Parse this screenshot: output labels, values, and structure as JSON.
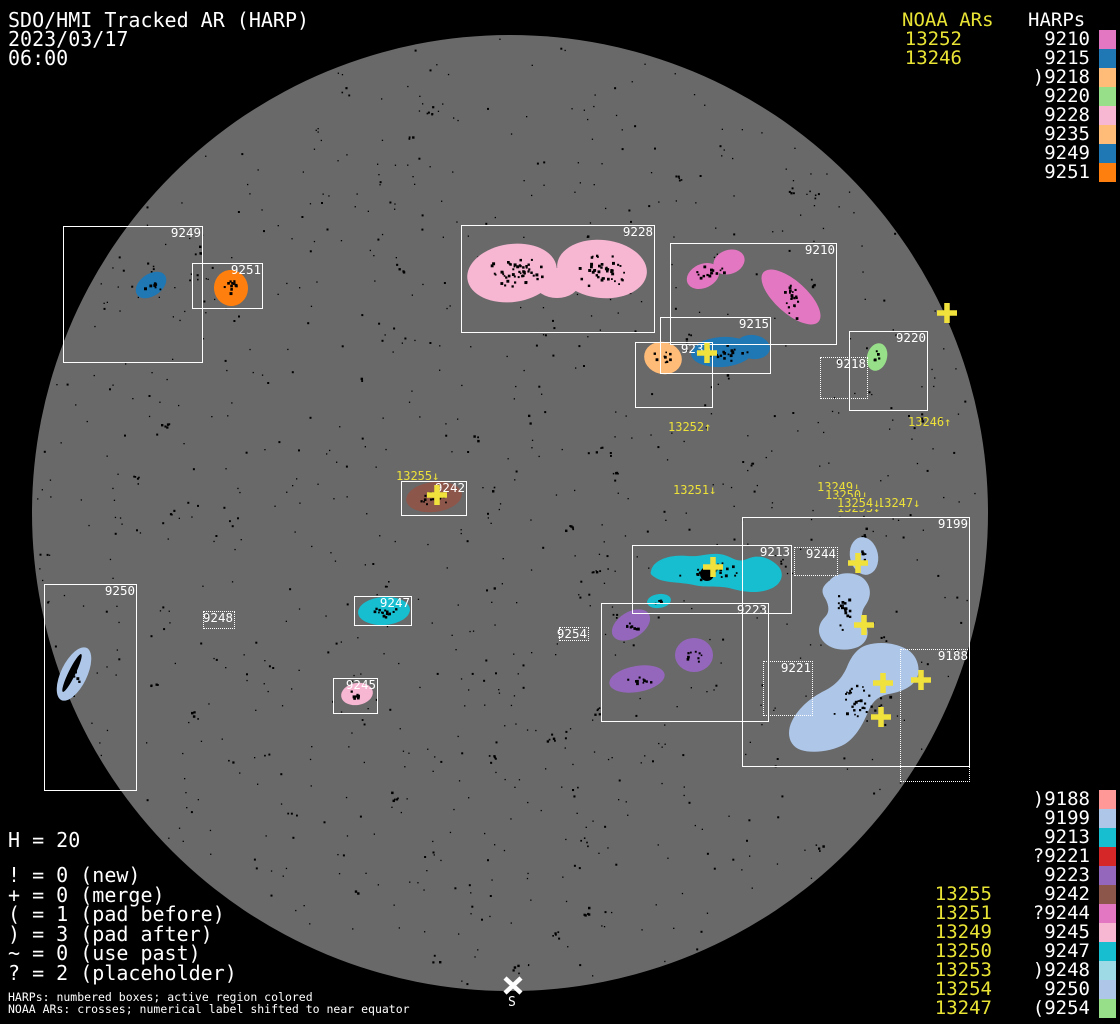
{
  "header": {
    "title": "SDO/HMI Tracked AR (HARP)",
    "date": "2023/03/17",
    "time": "06:00"
  },
  "colors": {
    "background": "#000000",
    "disk": "#696969",
    "box_border": "#ffffff",
    "noaa_text": "#e8e334",
    "cross": "#f0e13c",
    "speckle": "#000000"
  },
  "legend_top": {
    "noaa_header": "NOAA ARs",
    "harp_header": "HARPs",
    "rows": [
      {
        "noaa": "13252",
        "harp": "9210",
        "color": "#e377c2"
      },
      {
        "noaa": "13246",
        "harp": "9215",
        "color": "#1f77b4"
      },
      {
        "noaa": "",
        "harp": ")9218",
        "color": "#ffbb78"
      },
      {
        "noaa": "",
        "harp": "9220",
        "color": "#98df8a"
      },
      {
        "noaa": "",
        "harp": "9228",
        "color": "#f7b6d2"
      },
      {
        "noaa": "",
        "harp": "9235",
        "color": "#ffbb78"
      },
      {
        "noaa": "",
        "harp": "9249",
        "color": "#1f77b4"
      },
      {
        "noaa": "",
        "harp": "9251",
        "color": "#ff7f0e"
      }
    ]
  },
  "legend_bottom": {
    "rows": [
      {
        "noaa": "",
        "harp": ")9188",
        "color": "#ff9896"
      },
      {
        "noaa": "",
        "harp": "9199",
        "color": "#aec7e8"
      },
      {
        "noaa": "",
        "harp": "9213",
        "color": "#17becf"
      },
      {
        "noaa": "",
        "harp": "?9221",
        "color": "#d62728"
      },
      {
        "noaa": "",
        "harp": "9223",
        "color": "#9467bd"
      },
      {
        "noaa": "13255",
        "harp": "9242",
        "color": "#8c564b"
      },
      {
        "noaa": "13251",
        "harp": "?9244",
        "color": "#e377c2"
      },
      {
        "noaa": "13249",
        "harp": "9245",
        "color": "#f7b6d2"
      },
      {
        "noaa": "13250",
        "harp": "9247",
        "color": "#17becf"
      },
      {
        "noaa": "13253",
        "harp": ")9248",
        "color": "#9edae5"
      },
      {
        "noaa": "13254",
        "harp": "9250",
        "color": "#aec7e8"
      },
      {
        "noaa": "13247",
        "harp": "(9254",
        "color": "#98df8a"
      }
    ]
  },
  "stats": {
    "h_line": "H = 20",
    "lines": [
      "! = 0 (new)",
      "+ = 0 (merge)",
      "( = 1 (pad before)",
      ") = 3 (pad after)",
      "~ = 0 (use past)",
      "? = 2 (placeholder)"
    ]
  },
  "footnotes": [
    "HARPs: numbered boxes; active region colored",
    "NOAA ARs: crosses; numerical label shifted to near equator"
  ],
  "south_marker": {
    "x": 513,
    "y": 985,
    "label": "S"
  },
  "disk": {
    "cx": 510,
    "cy": 513,
    "r": 478
  },
  "harp_boxes": [
    {
      "label": "9249",
      "x": 63,
      "y": 226,
      "w": 140,
      "h": 137,
      "dotted": false
    },
    {
      "label": "9251",
      "x": 192,
      "y": 263,
      "w": 71,
      "h": 46,
      "dotted": false
    },
    {
      "label": "9228",
      "x": 461,
      "y": 225,
      "w": 194,
      "h": 108,
      "dotted": false
    },
    {
      "label": "9210",
      "x": 670,
      "y": 243,
      "w": 167,
      "h": 102,
      "dotted": false
    },
    {
      "label": "9215",
      "x": 660,
      "y": 317,
      "w": 111,
      "h": 57,
      "dotted": false
    },
    {
      "label": "9235",
      "x": 635,
      "y": 342,
      "w": 78,
      "h": 66,
      "dotted": false
    },
    {
      "label": "9220",
      "x": 849,
      "y": 331,
      "w": 79,
      "h": 80,
      "dotted": false
    },
    {
      "label": "9218",
      "x": 820,
      "y": 357,
      "w": 48,
      "h": 42,
      "dotted": true
    },
    {
      "label": "9242",
      "x": 401,
      "y": 481,
      "w": 66,
      "h": 35,
      "dotted": false
    },
    {
      "label": "9250",
      "x": 44,
      "y": 584,
      "w": 93,
      "h": 207,
      "dotted": false
    },
    {
      "label": "9247",
      "x": 354,
      "y": 596,
      "w": 58,
      "h": 30,
      "dotted": false
    },
    {
      "label": "9245",
      "x": 333,
      "y": 678,
      "w": 45,
      "h": 36,
      "dotted": false
    },
    {
      "label": "9248",
      "x": 203,
      "y": 611,
      "w": 32,
      "h": 18,
      "dotted": true
    },
    {
      "label": "9254",
      "x": 559,
      "y": 627,
      "w": 30,
      "h": 14,
      "dotted": true
    },
    {
      "label": "9213",
      "x": 632,
      "y": 545,
      "w": 160,
      "h": 69,
      "dotted": false
    },
    {
      "label": "9223",
      "x": 601,
      "y": 603,
      "w": 168,
      "h": 119,
      "dotted": false
    },
    {
      "label": "9199",
      "x": 742,
      "y": 517,
      "w": 228,
      "h": 250,
      "dotted": false
    },
    {
      "label": "9244",
      "x": 794,
      "y": 547,
      "w": 44,
      "h": 29,
      "dotted": true
    },
    {
      "label": "9221",
      "x": 763,
      "y": 661,
      "w": 50,
      "h": 55,
      "dotted": true
    },
    {
      "label": "9188",
      "x": 900,
      "y": 649,
      "w": 70,
      "h": 133,
      "dotted": true
    }
  ],
  "noaa_disk_labels": [
    {
      "text": "13252↑",
      "x": 668,
      "y": 421,
      "bg": false
    },
    {
      "text": "13246↑",
      "x": 908,
      "y": 416,
      "bg": false
    },
    {
      "text": "13255↓",
      "x": 396,
      "y": 470,
      "bg": false
    },
    {
      "text": "13251↓",
      "x": 673,
      "y": 484,
      "bg": false
    },
    {
      "text": "13249↓",
      "x": 817,
      "y": 481,
      "bg": false
    },
    {
      "text": "13250↓",
      "x": 825,
      "y": 489,
      "bg": true
    },
    {
      "text": "13253↓",
      "x": 837,
      "y": 502,
      "bg": true
    },
    {
      "text": "13247↓",
      "x": 877,
      "y": 497,
      "bg": true
    },
    {
      "text": "13254↓",
      "x": 837,
      "y": 497,
      "bg": true
    }
  ],
  "crosses": [
    [
      707,
      353
    ],
    [
      947,
      313
    ],
    [
      437,
      495
    ],
    [
      713,
      567
    ],
    [
      858,
      563
    ],
    [
      864,
      625
    ],
    [
      883,
      683
    ],
    [
      921,
      680
    ],
    [
      881,
      717
    ]
  ],
  "active_regions": [
    {
      "harp": "9249",
      "color": "#1f77b4",
      "shapes": [
        {
          "t": "e",
          "cx": 151,
          "cy": 285,
          "rx": 17,
          "ry": 11,
          "rot": -35
        }
      ],
      "speckles": [
        {
          "cx": 151,
          "cy": 285,
          "n": 8,
          "sx": 11,
          "sy": 6
        }
      ]
    },
    {
      "harp": "9251",
      "color": "#ff7f0e",
      "shapes": [
        {
          "t": "e",
          "cx": 231,
          "cy": 288,
          "rx": 17,
          "ry": 18,
          "rot": -8
        }
      ],
      "speckles": [
        {
          "cx": 231,
          "cy": 287,
          "n": 14,
          "sx": 11,
          "sy": 12
        }
      ]
    },
    {
      "harp": "9228",
      "color": "#f7b6d2",
      "shapes": [
        {
          "t": "e",
          "cx": 512,
          "cy": 273,
          "rx": 45,
          "ry": 29,
          "rot": -8
        },
        {
          "t": "e",
          "cx": 602,
          "cy": 269,
          "rx": 45,
          "ry": 29,
          "rot": 6
        },
        {
          "t": "e",
          "cx": 557,
          "cy": 283,
          "rx": 22,
          "ry": 15,
          "rot": 0
        }
      ],
      "speckles": [
        {
          "cx": 514,
          "cy": 272,
          "n": 50,
          "sx": 36,
          "sy": 20
        },
        {
          "cx": 600,
          "cy": 268,
          "n": 42,
          "sx": 30,
          "sy": 22
        }
      ]
    },
    {
      "harp": "9210",
      "color": "#e377c2",
      "shapes": [
        {
          "t": "e",
          "cx": 703,
          "cy": 276,
          "rx": 17,
          "ry": 12,
          "rot": -25
        },
        {
          "t": "e",
          "cx": 729,
          "cy": 262,
          "rx": 16,
          "ry": 12,
          "rot": -20
        },
        {
          "t": "e",
          "cx": 791,
          "cy": 297,
          "rx": 37,
          "ry": 16,
          "rot": 42
        }
      ],
      "speckles": [
        {
          "cx": 710,
          "cy": 271,
          "n": 16,
          "sx": 18,
          "sy": 10
        },
        {
          "cx": 791,
          "cy": 297,
          "n": 20,
          "sx": 12,
          "sy": 24
        }
      ]
    },
    {
      "harp": "9215",
      "color": "#1f77b4",
      "shapes": [
        {
          "t": "e",
          "cx": 722,
          "cy": 352,
          "rx": 31,
          "ry": 15,
          "rot": -4
        },
        {
          "t": "e",
          "cx": 753,
          "cy": 347,
          "rx": 17,
          "ry": 12,
          "rot": 8
        }
      ],
      "speckles": [
        {
          "cx": 727,
          "cy": 352,
          "n": 20,
          "sx": 28,
          "sy": 10
        }
      ]
    },
    {
      "harp": "9235",
      "color": "#ffbb78",
      "shapes": [
        {
          "t": "e",
          "cx": 663,
          "cy": 358,
          "rx": 19,
          "ry": 16,
          "rot": 14
        }
      ],
      "speckles": [
        {
          "cx": 661,
          "cy": 357,
          "n": 9,
          "sx": 12,
          "sy": 10
        }
      ]
    },
    {
      "harp": "9220",
      "color": "#98df8a",
      "shapes": [
        {
          "t": "e",
          "cx": 877,
          "cy": 357,
          "rx": 10,
          "ry": 14,
          "rot": 16
        }
      ],
      "speckles": [
        {
          "cx": 875,
          "cy": 354,
          "n": 5,
          "sx": 5,
          "sy": 8
        }
      ]
    },
    {
      "harp": "9242",
      "color": "#8c564b",
      "shapes": [
        {
          "t": "e",
          "cx": 434,
          "cy": 497,
          "rx": 28,
          "ry": 15,
          "rot": -7
        }
      ],
      "speckles": [
        {
          "cx": 434,
          "cy": 497,
          "n": 18,
          "sx": 20,
          "sy": 10
        }
      ]
    },
    {
      "harp": "9250",
      "color": "#aec7e8",
      "shapes": [
        {
          "t": "e",
          "cx": 74,
          "cy": 674,
          "rx": 13,
          "ry": 29,
          "rot": 26
        },
        {
          "t": "e",
          "cx": 72,
          "cy": 673,
          "rx": 3.5,
          "ry": 21,
          "rot": 26,
          "fill": "#000000"
        }
      ],
      "speckles": [
        {
          "cx": 74,
          "cy": 672,
          "n": 5,
          "sx": 5,
          "sy": 14
        }
      ]
    },
    {
      "harp": "9247",
      "color": "#17becf",
      "shapes": [
        {
          "t": "e",
          "cx": 384,
          "cy": 611,
          "rx": 26,
          "ry": 14,
          "rot": -4
        }
      ],
      "speckles": [
        {
          "cx": 384,
          "cy": 611,
          "n": 15,
          "sx": 18,
          "sy": 8
        }
      ]
    },
    {
      "harp": "9245",
      "color": "#f7b6d2",
      "shapes": [
        {
          "t": "e",
          "cx": 357,
          "cy": 694,
          "rx": 16,
          "ry": 11,
          "rot": -10
        }
      ],
      "speckles": [
        {
          "cx": 356,
          "cy": 694,
          "n": 8,
          "sx": 10,
          "sy": 6
        }
      ]
    },
    {
      "harp": "9213",
      "color": "#17becf",
      "shapes": [
        {
          "t": "p",
          "d": "M651,571 C653,560 670,554 688,556 C700,557 707,553 719,554 C731,555 736,564 747,559 C759,553 772,559 779,567 C785,575 781,585 770,589 C758,594 744,592 733,589 C720,585 706,588 694,585 C680,582 664,583 656,578 C651,575 650,574 651,571 Z"
        },
        {
          "t": "e",
          "cx": 659,
          "cy": 601,
          "rx": 12,
          "ry": 7,
          "rot": -8
        },
        {
          "t": "c",
          "cx": 707,
          "cy": 574,
          "r": 7,
          "fill": "#000000"
        }
      ],
      "speckles": [
        {
          "cx": 712,
          "cy": 571,
          "n": 22,
          "sx": 40,
          "sy": 12
        },
        {
          "cx": 659,
          "cy": 601,
          "n": 4,
          "sx": 7,
          "sy": 3
        }
      ]
    },
    {
      "harp": "9223",
      "color": "#9467bd",
      "shapes": [
        {
          "t": "e",
          "cx": 631,
          "cy": 625,
          "rx": 21,
          "ry": 13,
          "rot": -32
        },
        {
          "t": "e",
          "cx": 694,
          "cy": 655,
          "rx": 19,
          "ry": 17,
          "rot": 0
        },
        {
          "t": "e",
          "cx": 637,
          "cy": 679,
          "rx": 28,
          "ry": 13,
          "rot": -10
        }
      ],
      "speckles": [
        {
          "cx": 631,
          "cy": 625,
          "n": 9,
          "sx": 13,
          "sy": 8
        },
        {
          "cx": 694,
          "cy": 655,
          "n": 9,
          "sx": 12,
          "sy": 10
        },
        {
          "cx": 637,
          "cy": 679,
          "n": 10,
          "sx": 16,
          "sy": 7
        }
      ]
    },
    {
      "harp": "9199",
      "color": "#aec7e8",
      "shapes": [
        {
          "t": "e",
          "cx": 864,
          "cy": 556,
          "rx": 14,
          "ry": 19,
          "rot": -12
        },
        {
          "t": "p",
          "d": "M830,580 C838,571 857,571 865,580 C872,588 871,598 865,606 C861,612 861,618 865,624 C870,632 868,642 858,647 C846,652 830,650 823,641 C816,632 819,623 825,617 C830,612 829,605 825,598 C820,590 823,586 830,580 Z"
        },
        {
          "t": "p",
          "d": "M801,750 C789,746 786,733 792,721 C799,707 812,697 824,691 C836,685 842,678 847,667 C851,657 857,648 867,645 C880,641 897,643 908,650 C917,656 921,668 917,678 C912,688 900,692 889,694 C878,696 872,702 868,712 C863,724 856,737 845,744 C833,751 813,754 801,750 Z"
        }
      ],
      "speckles": [
        {
          "cx": 864,
          "cy": 554,
          "n": 5,
          "sx": 8,
          "sy": 11
        },
        {
          "cx": 843,
          "cy": 610,
          "n": 18,
          "sx": 13,
          "sy": 24
        },
        {
          "cx": 858,
          "cy": 700,
          "n": 36,
          "sx": 40,
          "sy": 26
        }
      ]
    }
  ],
  "chart_data": {
    "type": "solar_disk_annotation",
    "title": "SDO/HMI Tracked AR (HARP)",
    "timestamp": "2023/03/17 06:00",
    "harp_count": 20,
    "flag_counts": {
      "new": 0,
      "merge": 0,
      "pad_before": 1,
      "pad_after": 3,
      "use_past": 0,
      "placeholder": 2
    },
    "harps": [
      {
        "id": "9188",
        "prefix": ")",
        "color": "#ff9896"
      },
      {
        "id": "9199",
        "prefix": "",
        "color": "#aec7e8"
      },
      {
        "id": "9210",
        "prefix": "",
        "color": "#e377c2",
        "noaa": "13252"
      },
      {
        "id": "9213",
        "prefix": "",
        "color": "#17becf"
      },
      {
        "id": "9215",
        "prefix": "",
        "color": "#1f77b4",
        "noaa": "13246"
      },
      {
        "id": "9218",
        "prefix": ")",
        "color": "#ffbb78"
      },
      {
        "id": "9220",
        "prefix": "",
        "color": "#98df8a"
      },
      {
        "id": "9221",
        "prefix": "?",
        "color": "#d62728"
      },
      {
        "id": "9223",
        "prefix": "",
        "color": "#9467bd"
      },
      {
        "id": "9228",
        "prefix": "",
        "color": "#f7b6d2"
      },
      {
        "id": "9235",
        "prefix": "",
        "color": "#ffbb78"
      },
      {
        "id": "9242",
        "prefix": "",
        "color": "#8c564b",
        "noaa": "13255"
      },
      {
        "id": "9244",
        "prefix": "?",
        "color": "#e377c2",
        "noaa": "13251"
      },
      {
        "id": "9245",
        "prefix": "",
        "color": "#f7b6d2",
        "noaa": "13249"
      },
      {
        "id": "9247",
        "prefix": "",
        "color": "#17becf",
        "noaa": "13250"
      },
      {
        "id": "9248",
        "prefix": ")",
        "color": "#9edae5",
        "noaa": "13253"
      },
      {
        "id": "9249",
        "prefix": "",
        "color": "#1f77b4"
      },
      {
        "id": "9250",
        "prefix": "",
        "color": "#aec7e8",
        "noaa": "13254"
      },
      {
        "id": "9251",
        "prefix": "",
        "color": "#ff7f0e"
      },
      {
        "id": "9254",
        "prefix": "(",
        "color": "#98df8a",
        "noaa": "13247"
      }
    ]
  }
}
